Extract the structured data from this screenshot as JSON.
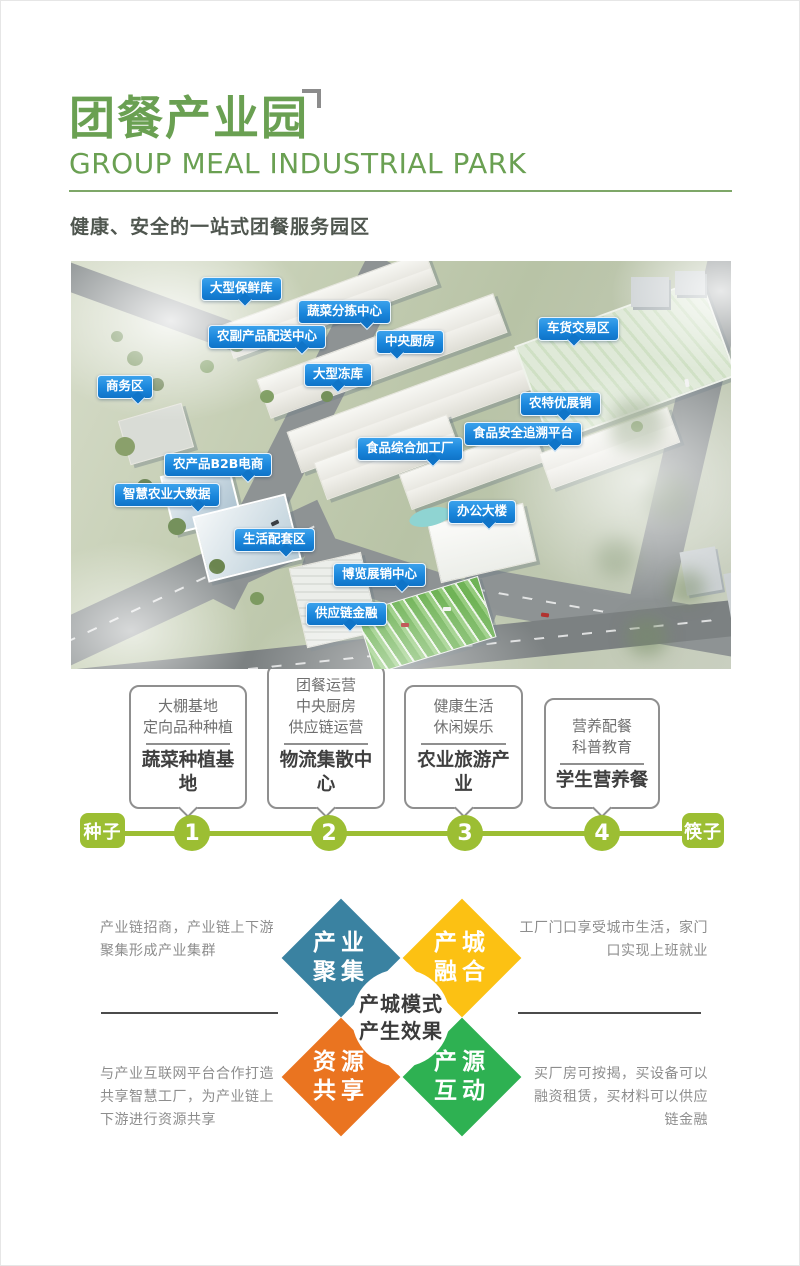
{
  "header": {
    "title_cn": "团餐产业园",
    "title_en": "GROUP MEAL INDUSTRIAL PARK",
    "subtitle": "健康、安全的一站式团餐服务园区"
  },
  "colors": {
    "brand_green": "#6aa052",
    "timeline_green": "#9cbe33",
    "label_blue": "#1a86dc",
    "quadrant_teal": "#3a82a1",
    "quadrant_yellow": "#fcc113",
    "quadrant_orange": "#ea7420",
    "quadrant_green": "#2eb152"
  },
  "map": {
    "labels": [
      "大型保鲜库",
      "蔬菜分拣中心",
      "农副产品配送中心",
      "中央厨房",
      "车货交易区",
      "大型冻库",
      "商务区",
      "农特优展销",
      "食品安全追溯平台",
      "食品综合加工厂",
      "农产品B2B电商",
      "智慧农业大数据",
      "办公大楼",
      "生活配套区",
      "博览展销中心",
      "供应链金融"
    ]
  },
  "timeline": {
    "start_label": "种子",
    "end_label": "筷子",
    "steps": [
      {
        "num": "1",
        "lines": [
          "大棚基地",
          "定向品种种植"
        ],
        "result": "蔬菜种植基地"
      },
      {
        "num": "2",
        "lines": [
          "团餐运营",
          "中央厨房",
          "供应链运营"
        ],
        "result": "物流集散中心"
      },
      {
        "num": "3",
        "lines": [
          "健康生活",
          "休闲娱乐"
        ],
        "result": "农业旅游产业"
      },
      {
        "num": "4",
        "lines": [
          "营养配餐",
          "科普教育"
        ],
        "result": "学生营养餐"
      }
    ]
  },
  "effects": {
    "center": {
      "line1": "产城模式",
      "line2": "产生效果"
    },
    "quadrants": [
      {
        "line1": "产业",
        "line2": "聚集"
      },
      {
        "line1": "产城",
        "line2": "融合"
      },
      {
        "line1": "资源",
        "line2": "共享"
      },
      {
        "line1": "产源",
        "line2": "互动"
      }
    ],
    "notes": [
      {
        "lines": [
          "产业链招商，产业链上下游",
          "聚集形成产业集群"
        ]
      },
      {
        "lines": [
          "工厂门口享受城市生活，家门",
          "口实现上班就业"
        ]
      },
      {
        "lines": [
          "与产业互联网平台合作打造",
          "共享智慧工厂，为产业链上",
          "下游进行资源共享"
        ]
      },
      {
        "lines": [
          "买厂房可按揭，买设备可以",
          "融资租赁，买材料可以供应",
          "链金融"
        ]
      }
    ]
  }
}
